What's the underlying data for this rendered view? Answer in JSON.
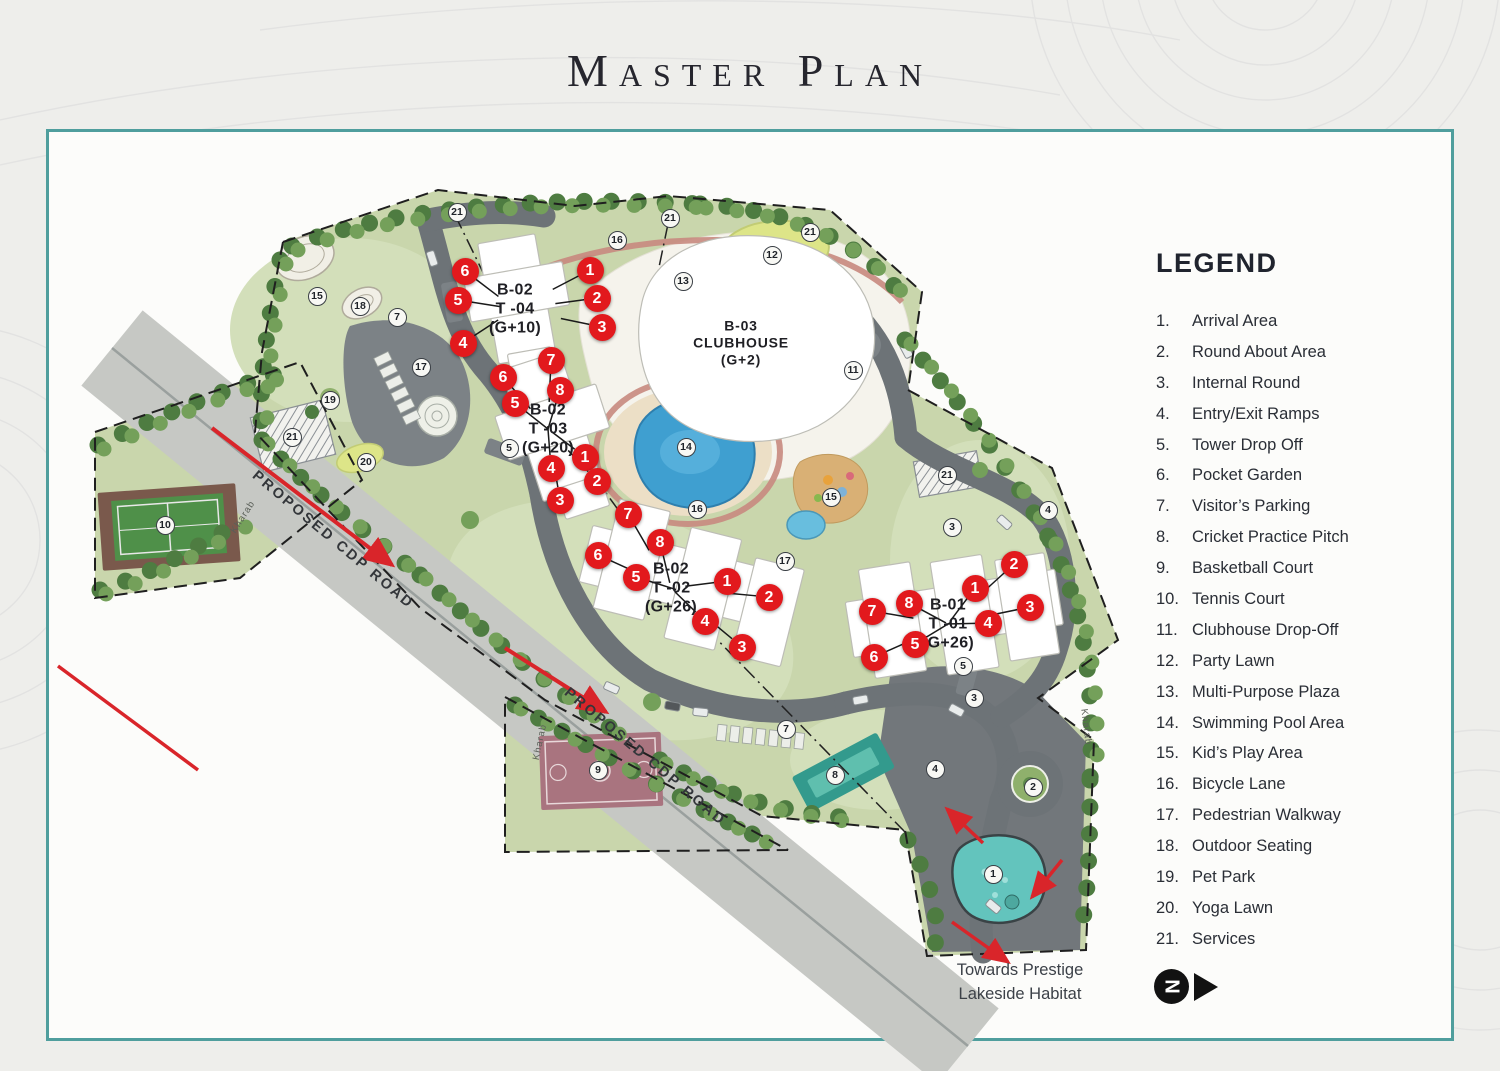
{
  "title": "Master Plan",
  "legend": {
    "title": "LEGEND",
    "items": [
      {
        "num": "1.",
        "label": "Arrival Area"
      },
      {
        "num": "2.",
        "label": "Round About Area"
      },
      {
        "num": "3.",
        "label": "Internal Round"
      },
      {
        "num": "4.",
        "label": "Entry/Exit Ramps"
      },
      {
        "num": "5.",
        "label": "Tower Drop Off"
      },
      {
        "num": "6.",
        "label": "Pocket Garden"
      },
      {
        "num": "7.",
        "label": "Visitor’s Parking"
      },
      {
        "num": "8.",
        "label": "Cricket Practice Pitch"
      },
      {
        "num": "9.",
        "label": "Basketball Court"
      },
      {
        "num": "10.",
        "label": "Tennis Court"
      },
      {
        "num": "11.",
        "label": "Clubhouse Drop-Off"
      },
      {
        "num": "12.",
        "label": "Party Lawn"
      },
      {
        "num": "13.",
        "label": "Multi-Purpose Plaza"
      },
      {
        "num": "14.",
        "label": "Swimming Pool Area"
      },
      {
        "num": "15.",
        "label": "Kid’s Play Area"
      },
      {
        "num": "16.",
        "label": "Bicycle Lane"
      },
      {
        "num": "17.",
        "label": "Pedestrian Walkway"
      },
      {
        "num": "18.",
        "label": "Outdoor Seating"
      },
      {
        "num": "19.",
        "label": "Pet Park"
      },
      {
        "num": "20.",
        "label": "Yoga Lawn"
      },
      {
        "num": "21.",
        "label": "Services"
      }
    ]
  },
  "map": {
    "buildings": [
      {
        "id": "t04",
        "lines": [
          "B-02",
          "T -04",
          "(G+10)"
        ],
        "x": 515,
        "y": 309
      },
      {
        "id": "t03",
        "lines": [
          "B-02",
          "T -03",
          "(G+20)"
        ],
        "x": 548,
        "y": 429
      },
      {
        "id": "t02",
        "lines": [
          "B-02",
          "T -02",
          "(G+26)"
        ],
        "x": 671,
        "y": 588
      },
      {
        "id": "t01",
        "lines": [
          "B-01",
          "T -01",
          "(G+26)"
        ],
        "x": 948,
        "y": 624
      },
      {
        "id": "club",
        "lines": [
          "B-03",
          "CLUBHOUSE",
          "(G+2)"
        ],
        "x": 741,
        "y": 343
      }
    ],
    "red_markers": [
      {
        "n": "6",
        "x": 465,
        "y": 271,
        "b": "t04"
      },
      {
        "n": "5",
        "x": 458,
        "y": 300,
        "b": "t04"
      },
      {
        "n": "4",
        "x": 463,
        "y": 343,
        "b": "t04"
      },
      {
        "n": "1",
        "x": 590,
        "y": 270,
        "b": "t04"
      },
      {
        "n": "2",
        "x": 597,
        "y": 298,
        "b": "t04"
      },
      {
        "n": "3",
        "x": 602,
        "y": 327,
        "b": "t04"
      },
      {
        "n": "7",
        "x": 551,
        "y": 360,
        "b": "t03"
      },
      {
        "n": "6",
        "x": 503,
        "y": 377,
        "b": "t03"
      },
      {
        "n": "8",
        "x": 560,
        "y": 390,
        "b": "t03"
      },
      {
        "n": "5",
        "x": 515,
        "y": 403,
        "b": "t03"
      },
      {
        "n": "1",
        "x": 585,
        "y": 457,
        "b": "t03"
      },
      {
        "n": "4",
        "x": 551,
        "y": 468,
        "b": "t03"
      },
      {
        "n": "2",
        "x": 597,
        "y": 481,
        "b": "t03"
      },
      {
        "n": "3",
        "x": 560,
        "y": 500,
        "b": "t03"
      },
      {
        "n": "7",
        "x": 628,
        "y": 514,
        "b": "t02"
      },
      {
        "n": "8",
        "x": 660,
        "y": 542,
        "b": "t02"
      },
      {
        "n": "6",
        "x": 598,
        "y": 555,
        "b": "t02"
      },
      {
        "n": "5",
        "x": 636,
        "y": 577,
        "b": "t02"
      },
      {
        "n": "1",
        "x": 727,
        "y": 581,
        "b": "t02"
      },
      {
        "n": "2",
        "x": 769,
        "y": 597,
        "b": "t02"
      },
      {
        "n": "4",
        "x": 705,
        "y": 621,
        "b": "t02"
      },
      {
        "n": "3",
        "x": 742,
        "y": 647,
        "b": "t02"
      },
      {
        "n": "2",
        "x": 1014,
        "y": 564,
        "b": "t01"
      },
      {
        "n": "1",
        "x": 975,
        "y": 588,
        "b": "t01"
      },
      {
        "n": "3",
        "x": 1030,
        "y": 607,
        "b": "t01"
      },
      {
        "n": "8",
        "x": 909,
        "y": 603,
        "b": "t01"
      },
      {
        "n": "7",
        "x": 872,
        "y": 611,
        "b": "t01"
      },
      {
        "n": "4",
        "x": 988,
        "y": 623,
        "b": "t01"
      },
      {
        "n": "5",
        "x": 915,
        "y": 644,
        "b": "t01"
      },
      {
        "n": "6",
        "x": 874,
        "y": 657,
        "b": "t01"
      }
    ],
    "circle_markers": [
      {
        "n": "21",
        "x": 457,
        "y": 212
      },
      {
        "n": "16",
        "x": 617,
        "y": 240
      },
      {
        "n": "21",
        "x": 670,
        "y": 218
      },
      {
        "n": "12",
        "x": 772,
        "y": 255
      },
      {
        "n": "21",
        "x": 810,
        "y": 232
      },
      {
        "n": "13",
        "x": 683,
        "y": 281
      },
      {
        "n": "15",
        "x": 317,
        "y": 296
      },
      {
        "n": "18",
        "x": 360,
        "y": 306
      },
      {
        "n": "7",
        "x": 397,
        "y": 317
      },
      {
        "n": "17",
        "x": 421,
        "y": 367
      },
      {
        "n": "19",
        "x": 330,
        "y": 400
      },
      {
        "n": "21",
        "x": 292,
        "y": 437
      },
      {
        "n": "20",
        "x": 366,
        "y": 462
      },
      {
        "n": "10",
        "x": 165,
        "y": 525
      },
      {
        "n": "14",
        "x": 686,
        "y": 447
      },
      {
        "n": "5",
        "x": 509,
        "y": 448
      },
      {
        "n": "15",
        "x": 831,
        "y": 497
      },
      {
        "n": "16",
        "x": 697,
        "y": 509
      },
      {
        "n": "3",
        "x": 952,
        "y": 527
      },
      {
        "n": "4",
        "x": 1048,
        "y": 510
      },
      {
        "n": "17",
        "x": 785,
        "y": 561
      },
      {
        "n": "11",
        "x": 853,
        "y": 370
      },
      {
        "n": "21",
        "x": 947,
        "y": 475
      },
      {
        "n": "5",
        "x": 963,
        "y": 666
      },
      {
        "n": "3",
        "x": 974,
        "y": 698
      },
      {
        "n": "7",
        "x": 786,
        "y": 729
      },
      {
        "n": "4",
        "x": 935,
        "y": 769
      },
      {
        "n": "8",
        "x": 835,
        "y": 775
      },
      {
        "n": "9",
        "x": 598,
        "y": 770
      },
      {
        "n": "2",
        "x": 1033,
        "y": 787
      },
      {
        "n": "1",
        "x": 993,
        "y": 874
      }
    ],
    "road_labels": [
      {
        "text": "PROPOSED CDP ROAD",
        "x": 333,
        "y": 540,
        "angle": 40
      },
      {
        "text": "PROPOSED CDP ROAD",
        "x": 645,
        "y": 757,
        "angle": 40
      }
    ],
    "edge_labels": [
      {
        "text": "Kharab",
        "x": 243,
        "y": 517,
        "angle": -57
      },
      {
        "text": "Kharab",
        "x": 540,
        "y": 742,
        "angle": -78
      },
      {
        "text": "Kharab",
        "x": 1086,
        "y": 727,
        "angle": 83
      }
    ],
    "note": {
      "lines": [
        "Towards Prestige",
        "Lakeside Habitat"
      ],
      "x": 1020,
      "y": 958
    },
    "north": {
      "label": "N"
    },
    "colors": {
      "frame": "#4f9e9d",
      "marker_red": "#e2191d",
      "road_dark": "#6d7377",
      "road_light": "#c6c8c4",
      "pool_blue": "#3f9fd0",
      "lawn_green": "#dde588",
      "green_base": "#c9d6ac",
      "tree_dark": "#4e7c41",
      "tree_light": "#74a05a",
      "arrow_red": "#d9252a"
    }
  }
}
